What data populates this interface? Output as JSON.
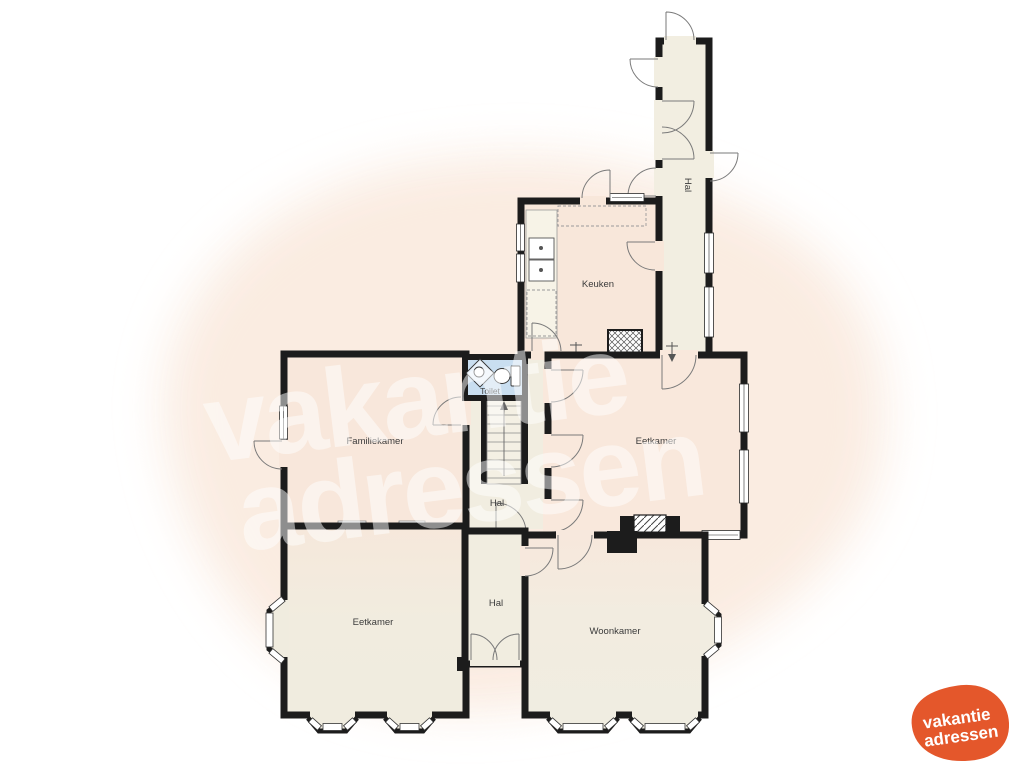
{
  "watermark": {
    "line1": "vakantie",
    "line2": "adressen",
    "color": "#ffffff"
  },
  "logo": {
    "line1": "vakantie",
    "line2": "adressen",
    "blob_color": "#e4572b",
    "text_color": "#ffffff"
  },
  "floorplan": {
    "wall_color": "#1c1c1c",
    "room_fill_warm": "#f8e7db",
    "room_fill_cream": "#f1ede0",
    "toilet_fill": "#c9def0",
    "background_blob_color": "#faebe0",
    "labels": {
      "hall_top": "Hal",
      "kitchen": "Keuken",
      "toilet": "Toilet",
      "family_room": "Familiekamer",
      "dining_room_upper": "Eetkamer",
      "hall_middle": "Hal",
      "dining_room_lower": "Eetkamer",
      "hall_lower": "Hal",
      "living_room": "Woonkamer"
    }
  }
}
